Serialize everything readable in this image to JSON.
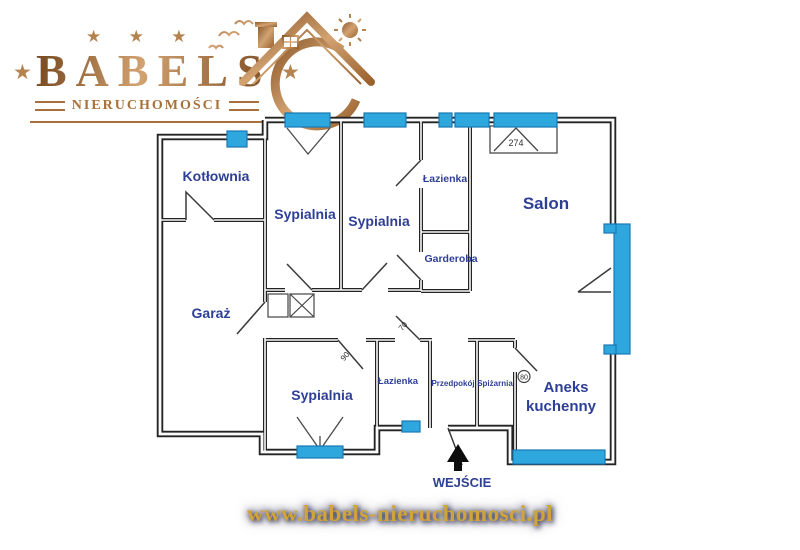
{
  "logo": {
    "brand": "BABELS",
    "subtitle": "NIERUCHOMOŚCI",
    "stars_top": "★ ★ ★",
    "star": "★",
    "copper_color": "#a9713a"
  },
  "footer": {
    "url": "www.babels-nieruchomosci.pl",
    "gold_color": "#d1a338"
  },
  "plan": {
    "window_color": "#2ea7de",
    "label_color": "#2e3f96",
    "rooms": {
      "kotlownia": "Kotłownia",
      "sypialnia_top_left": "Sypialnia",
      "sypialnia_top_mid": "Sypialnia",
      "lazienka_top": "Łazienka",
      "garderoba": "Garderoba",
      "salon": "Salon",
      "garaz": "Garaż",
      "sypialnia_bottom": "Sypialnia",
      "lazienka_bottom": "Łazienka",
      "przedpokoj": "Przedpokój",
      "spizarnia": "Spiżarnia",
      "aneks_line1": "Aneks",
      "aneks_line2": "kuchenny"
    },
    "dimensions": {
      "salon_window": "274",
      "bedroom_door": "90",
      "bathroom_door": "70",
      "pantry_door": "80"
    },
    "entrance": "WEJŚCIE"
  }
}
